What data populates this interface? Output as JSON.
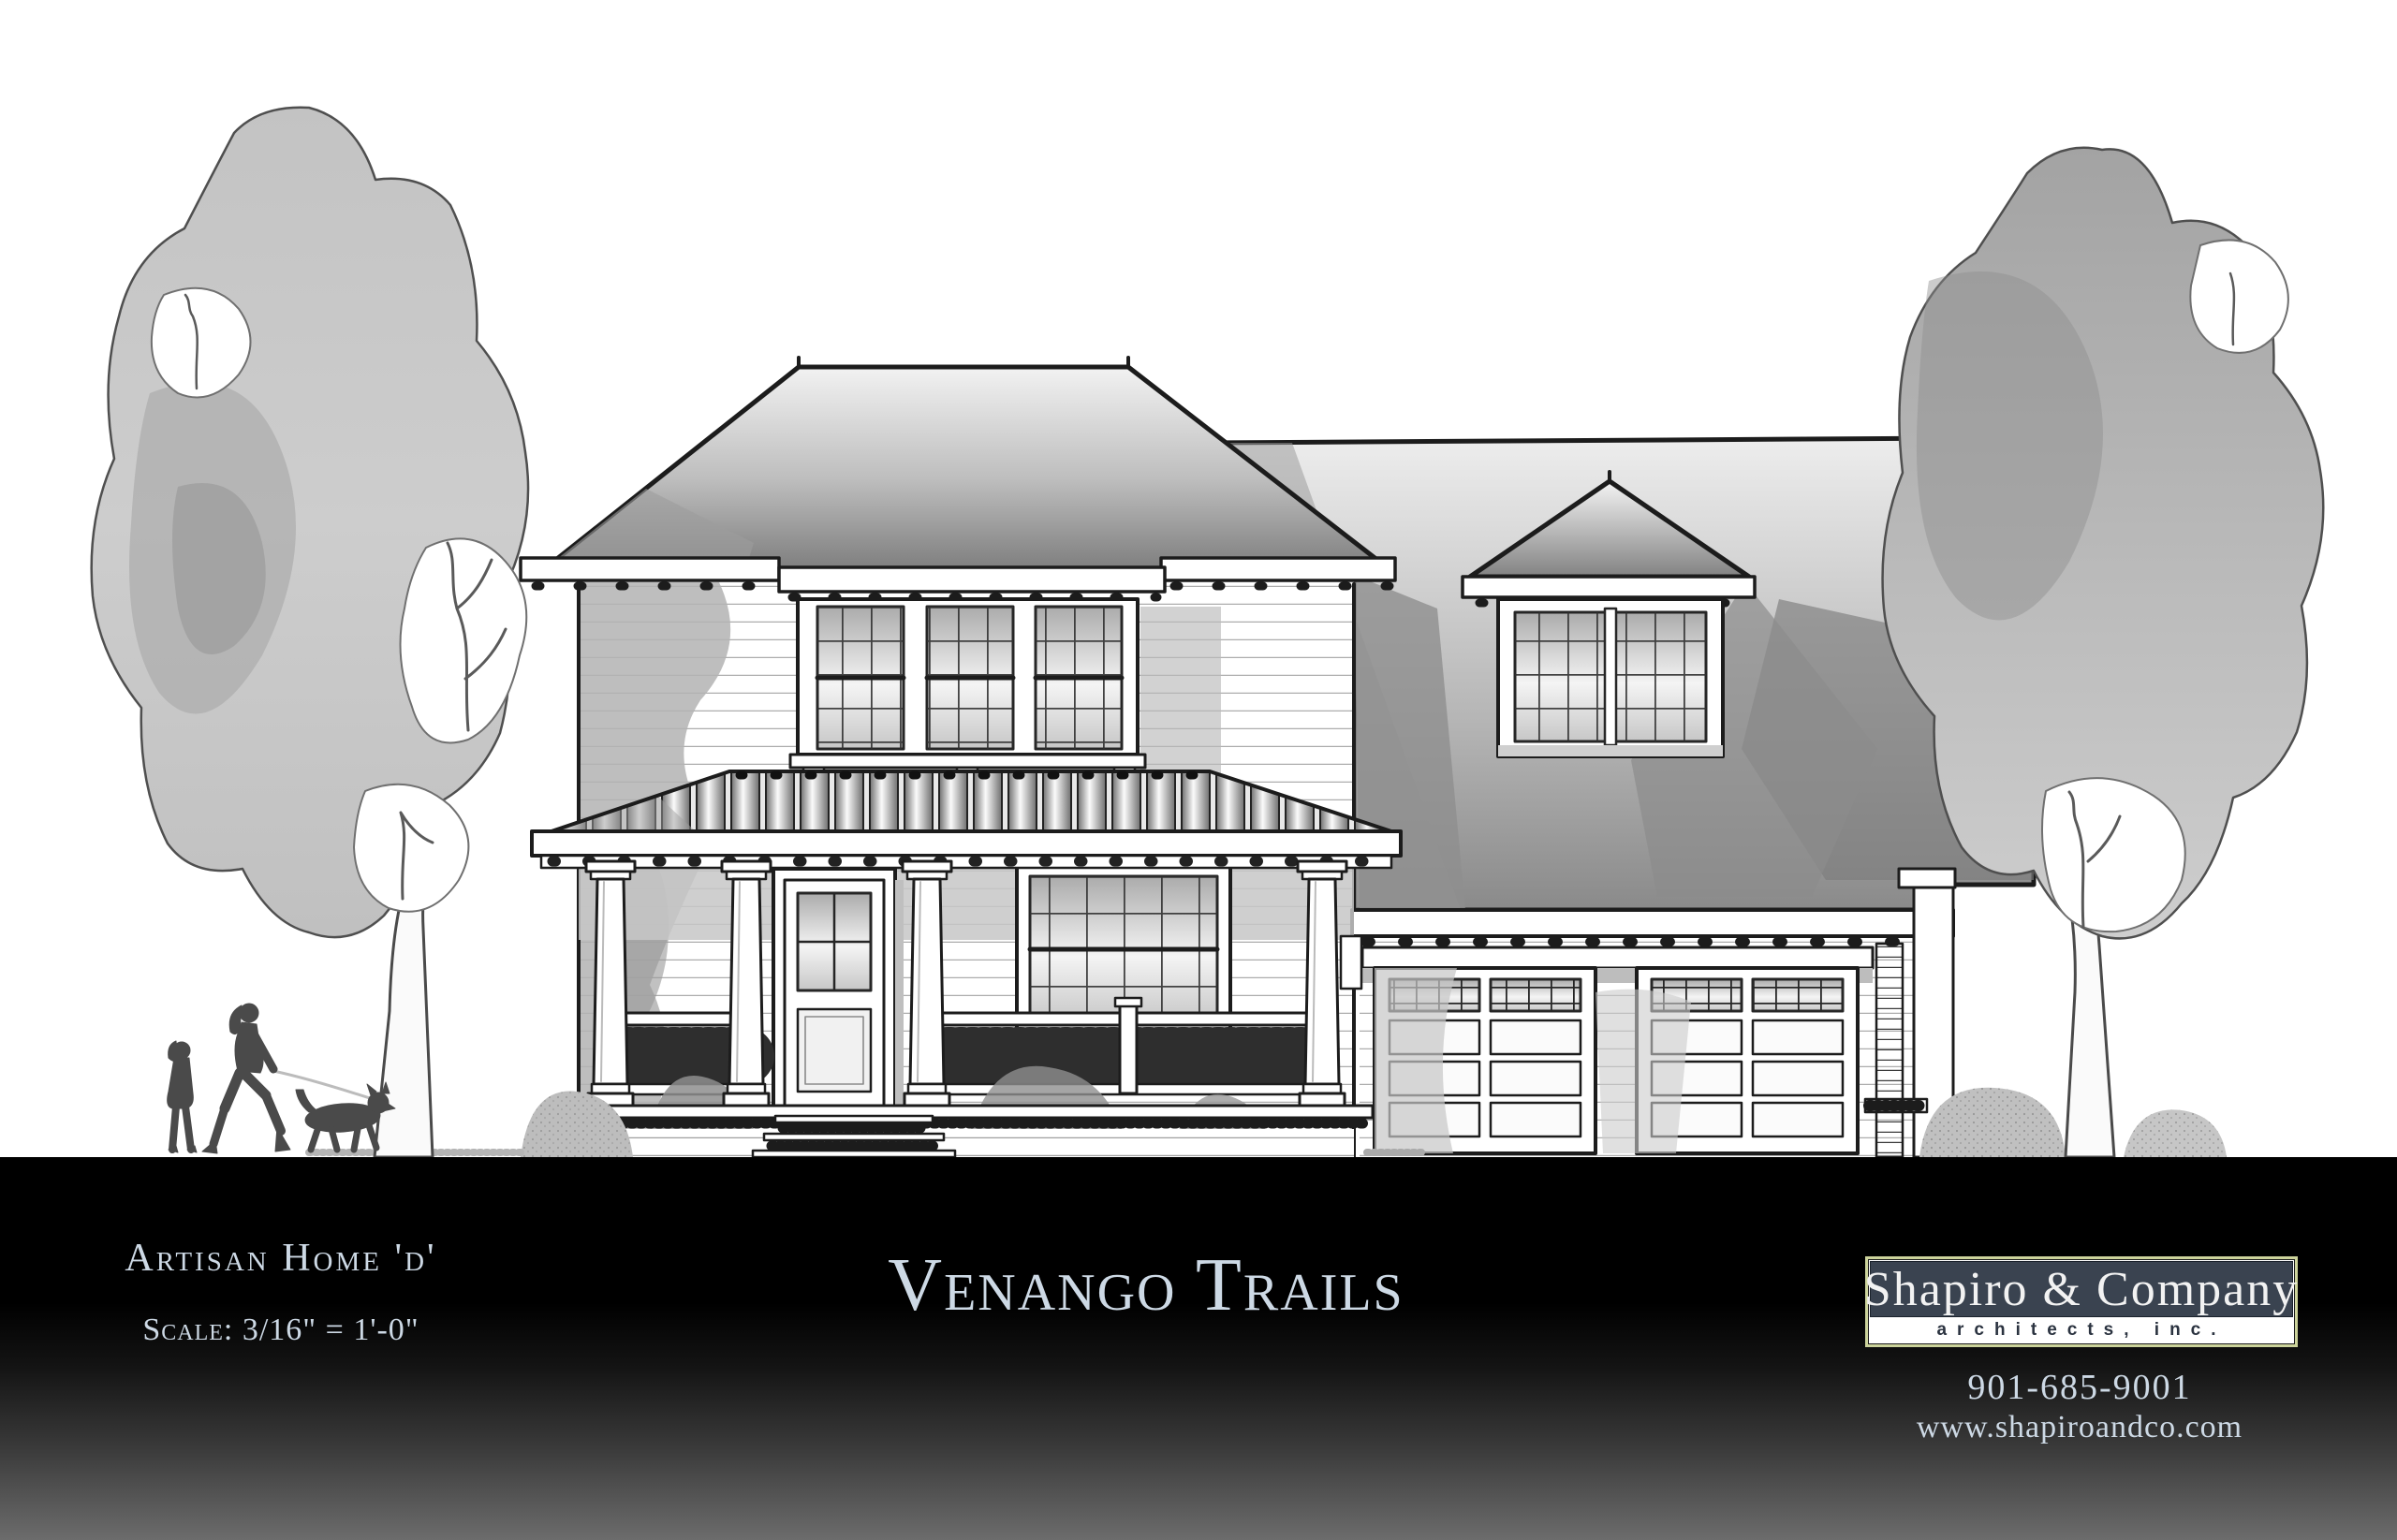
{
  "footer": {
    "plan": {
      "name": "Artisan Home 'd'",
      "scale": "Scale: 3/16\" = 1'-0\""
    },
    "project": {
      "title": "Venango Trails"
    },
    "firm": {
      "name": "Shapiro & Company",
      "subtitle": "architects, inc.",
      "phone": "901-685-9001",
      "website": "www.shapiroandco.com"
    }
  },
  "colors": {
    "ink": "#1c1c1c",
    "band-text": "#cdd9e5",
    "logo-border": "#ccd39b",
    "logo-bg": "#3a4350",
    "logo-text": "#f2f2f2",
    "logo-strip": "#ffffff",
    "logo-strip-text": "#2b3340"
  }
}
